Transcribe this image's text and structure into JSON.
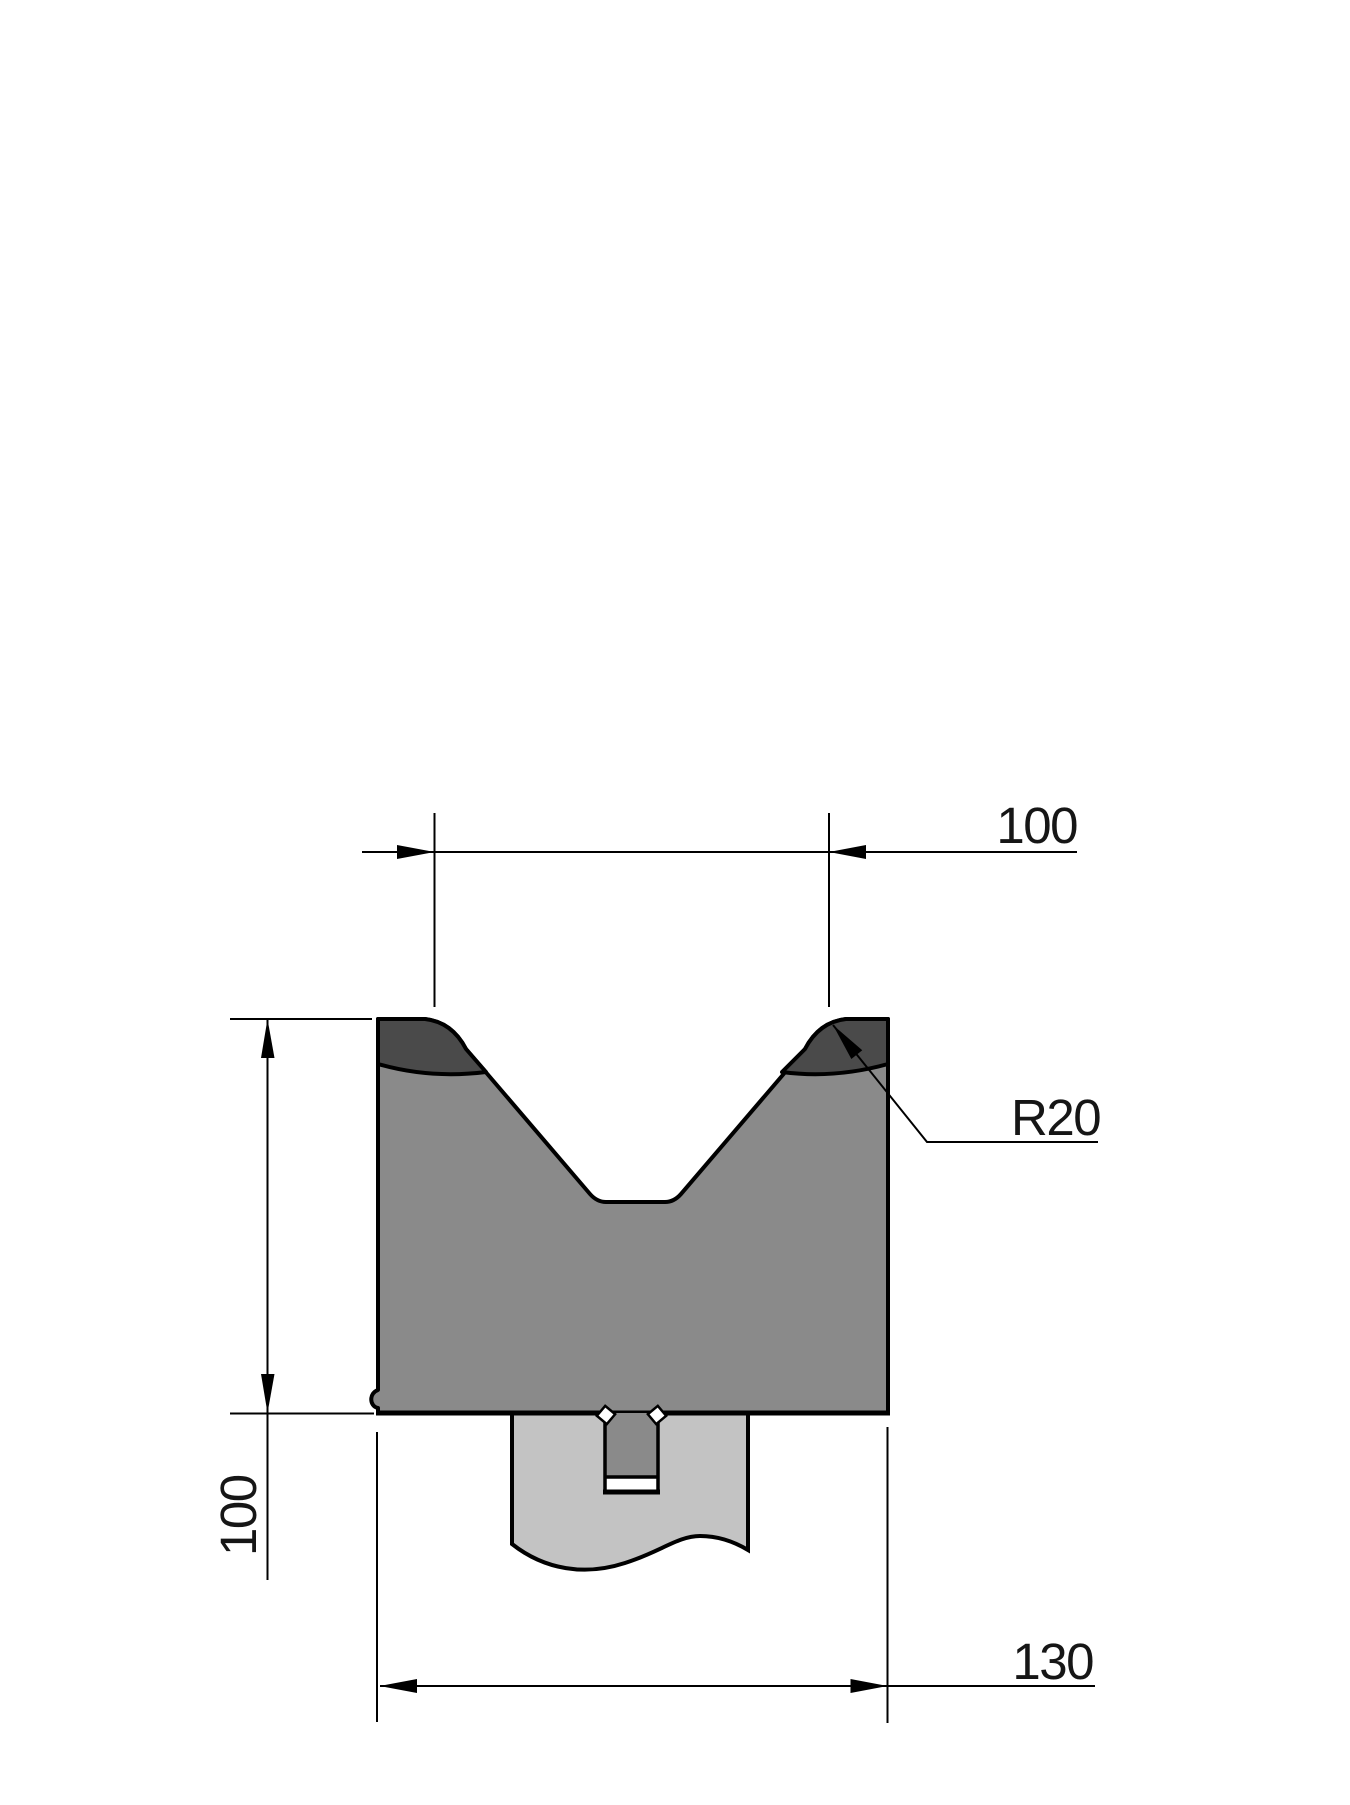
{
  "drawing": {
    "kind": "press-brake V-die section drawing",
    "labels": {
      "top_width": "100",
      "left_height": "100",
      "bottom_width": "130",
      "radius_callout": "R20"
    },
    "colors": {
      "background": "#FFFFFF",
      "outline": "#000000",
      "body_gray": "#8A8A8A",
      "hardened_zone_dark": "#4A4A4A",
      "holder_gray": "#C3C3C3",
      "slot_gap_white": "#FFFFFF"
    }
  }
}
